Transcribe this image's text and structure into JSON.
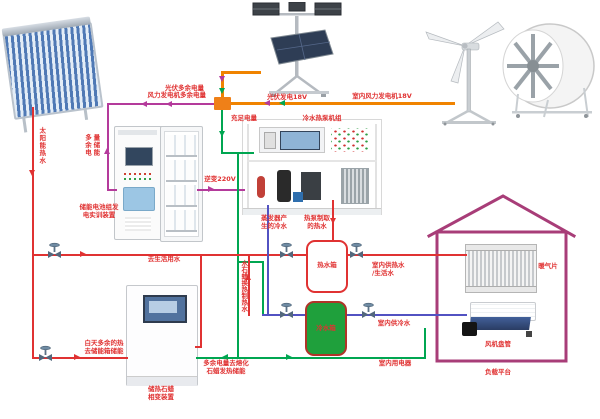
{
  "labels": {
    "pv_surplus": "光伏多余电量",
    "wind_surplus": "风力发电机多余电量",
    "pv_gen": "光伏发电18V",
    "indoor_wind_gen": "室内风力发电机18V",
    "sufficient_power": "充足电量",
    "heat_pump_unit": "冷水热泵机组",
    "inverter": "逆变220V",
    "surplus_to_storage": "多余电量储能",
    "battery_device": "储能电池组发\n电实训装置",
    "solar_hot_water": "太阳能热水",
    "to_domestic_water": "去生活用水",
    "evaporator_cold": "蒸发器产\n生的冷水",
    "heat_pump_hot": "热泵制取\n的热水",
    "hot_tank": "热水箱",
    "cold_tank": "冷水箱",
    "paraffin_exchange": "水石蜡换热制热水",
    "day_surplus_heat": "白天多余的热\n去储能箱储能",
    "paraffin_device": "储热石蜡\n相变装置",
    "melt_paraffin": "多余电量去熔化\n石蜡发热储能",
    "indoor_hot_supply": "室内供热水\n/生活水",
    "indoor_cold_supply": "室内供冷水",
    "indoor_electric": "室内用电器",
    "radiator": "暖气片",
    "fan_coil": "风机盘管",
    "load_platform": "负载平台"
  },
  "colors": {
    "red": "#e03232",
    "green": "#00a651",
    "purple": "#b43a9b",
    "orange": "#f08300",
    "blue": "#5252c2",
    "house": "#a83d78",
    "junction": "#ef8018",
    "tank_green": "#1fa03c",
    "tank_border": "#b03428"
  }
}
